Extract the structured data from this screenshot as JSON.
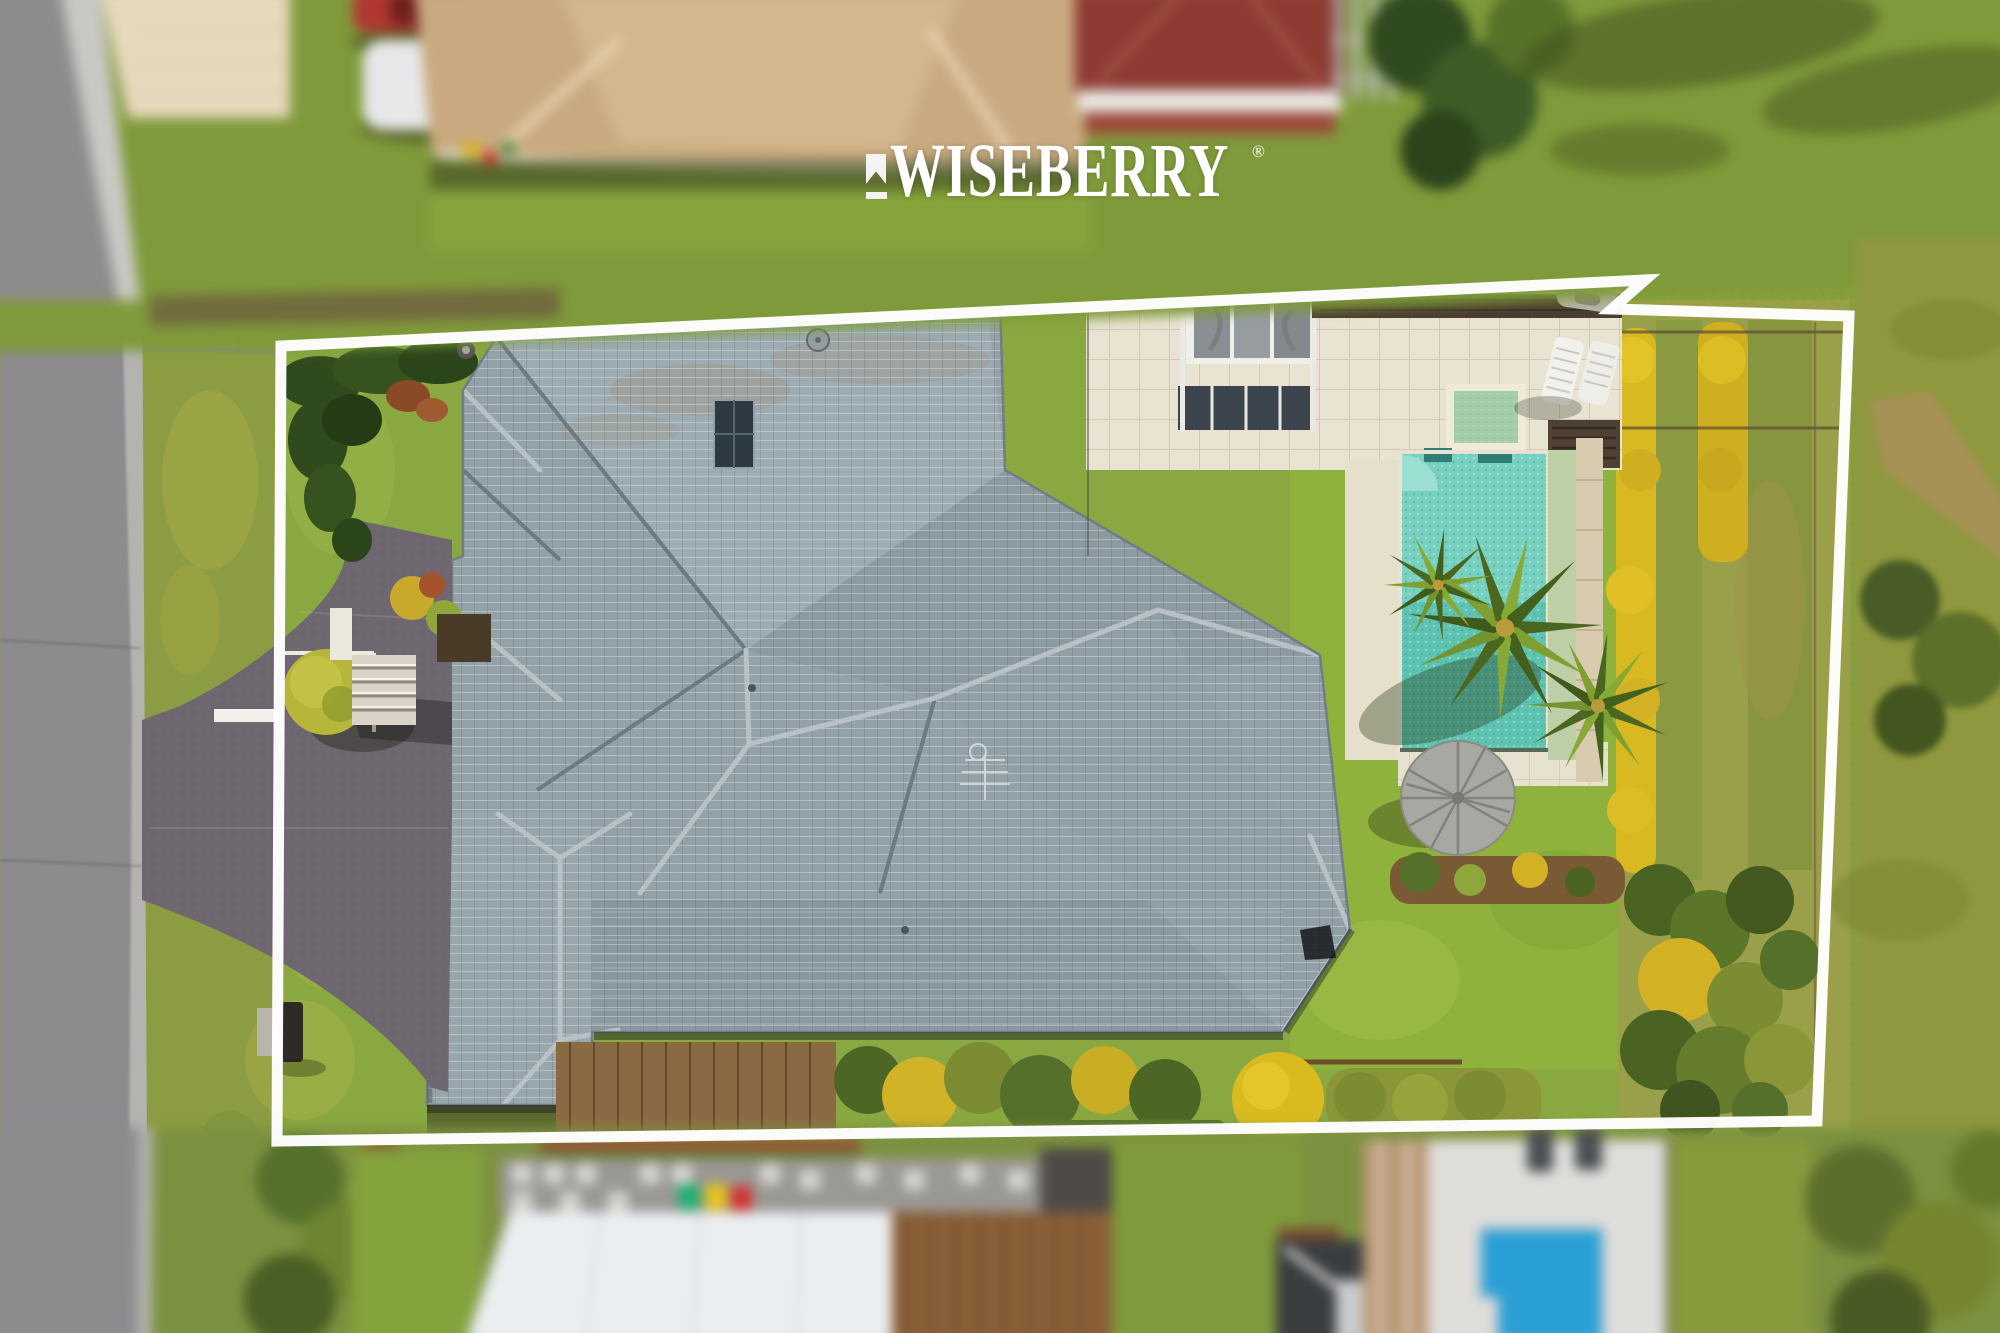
{
  "watermark": {
    "brand": "WISEBERRY",
    "registered": "®",
    "icon": "ribbon-flag-icon"
  },
  "scene": {
    "type": "aerial-drone-photo",
    "subject": "single residential property outlined in white",
    "features": [
      "road",
      "driveway",
      "grey tiled hip roof house",
      "solar panel",
      "swimming pool",
      "spa",
      "sun loungers",
      "palm trees",
      "umbrella gazebo",
      "golden hedges",
      "neighbouring houses",
      "wheelie bins",
      "neighbour pool"
    ]
  },
  "palette": {
    "boundary_white": "#FFFFFF",
    "roof_gray": "#93A2A8",
    "roof_ridge": "#B8C2C6",
    "roof_valley": "#6C7A82",
    "lawn_green": "#85A63F",
    "lawn_bright": "#8FB23C",
    "verge_olive": "#8C9C42",
    "hedge_dark": "#2F4A1C",
    "hedge_gold": "#D9B922",
    "pool_teal": "#64CBB9",
    "pool_blue_neighbor": "#2A9FD6",
    "driveway_asphalt": "#6E6770",
    "road_gray": "#8D8B8E",
    "paver_cream": "#E6D9BD",
    "paving_beige": "#E9E3D2",
    "tan_roof": "#C9AA80",
    "red_roof": "#8E3B33",
    "deck_brown": "#8A5F38",
    "bin_green": "#1FAE74",
    "bin_yellow": "#E8C416",
    "bin_red": "#D42F2F"
  }
}
